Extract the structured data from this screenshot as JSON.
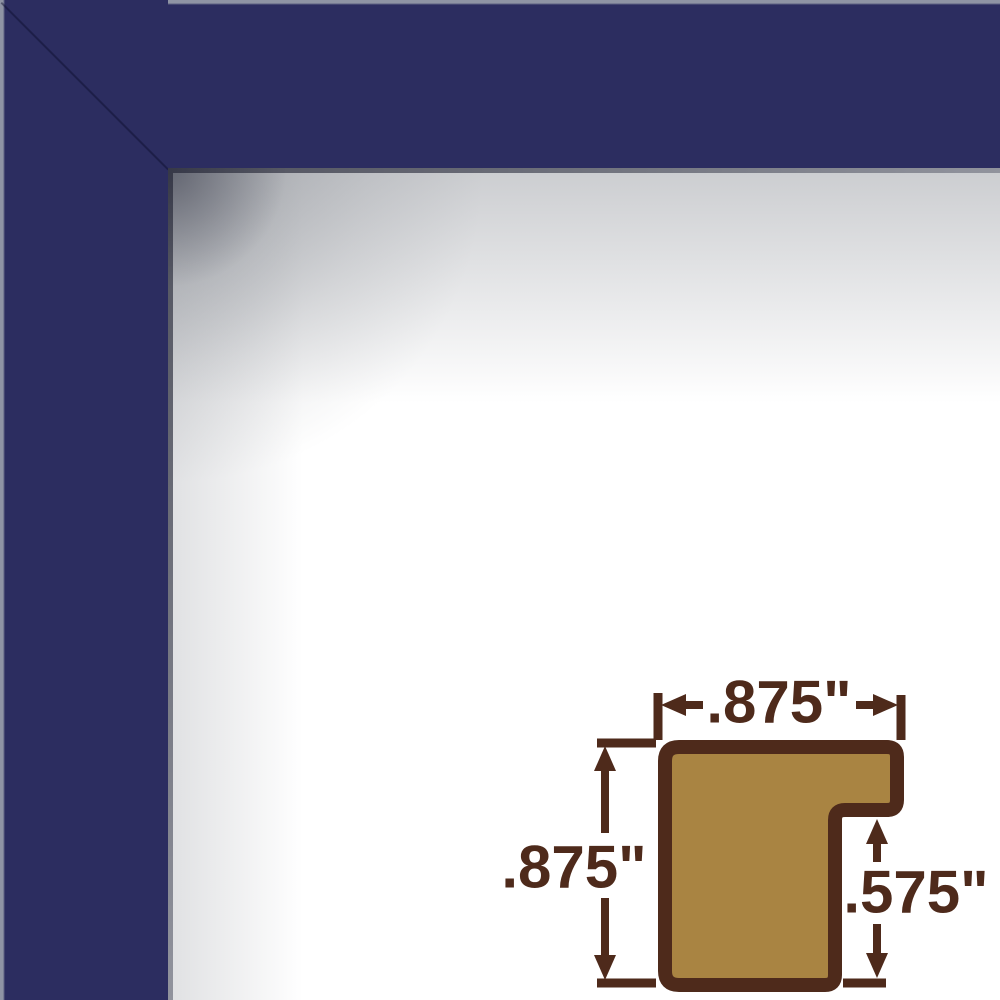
{
  "colors": {
    "frame_navy": "#2c2d60",
    "frame_edge_highlight": "#8f94a4",
    "lip_dark": "#4e505c",
    "lip_light": "#91939d",
    "diagram_brown": "#4e2a1b",
    "diagram_tan": "#a98442"
  },
  "frame": {
    "finish": "flat navy blue moulding corner"
  },
  "diagram": {
    "labels": {
      "top_width": ".875\"",
      "side_height": ".875\"",
      "rabbet_depth": ".575\""
    }
  }
}
